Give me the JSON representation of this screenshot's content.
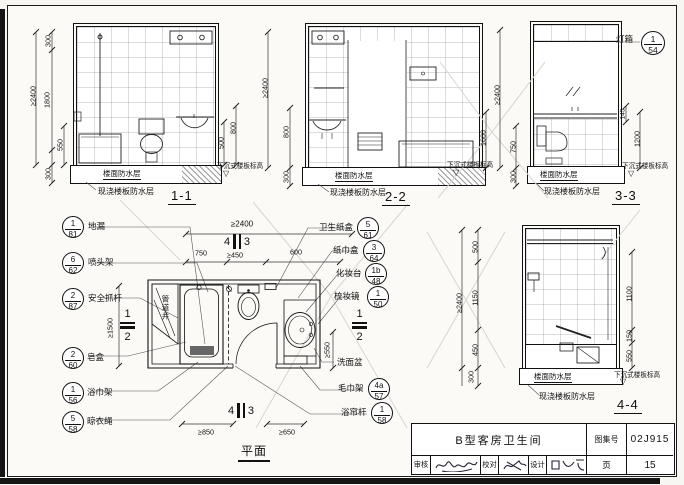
{
  "sheet": {
    "common": {
      "floor_wp": "楼面防水层",
      "slab_wp": "现浇楼板防水层",
      "sunken": "下沉式楼板标高",
      "tri": "▽"
    },
    "elev11": {
      "title": "1-1",
      "total": "≥2400",
      "seg_top": "300",
      "seg_mid": "1800",
      "seg_tub": "550",
      "seg_bot": "300",
      "right_inner": "500",
      "right_outer": "800"
    },
    "elev22": {
      "title": "2-2",
      "total": "≥2400",
      "left_upper": "800",
      "left_lower": "300",
      "right": "1600"
    },
    "elev33": {
      "title": "3-3",
      "total": "≥2400",
      "left_upper": "750",
      "left_lower": "300",
      "right_inner": "145",
      "right_outer": "1200",
      "lightbox_label": "灯箱",
      "lightbox_num": "1",
      "lightbox_den": "54"
    },
    "elev44": {
      "title": "4-4",
      "total": "≥2400",
      "l1": "500",
      "l2": "1150",
      "l3": "450",
      "l4": "300",
      "r1": "1100",
      "r2": "150",
      "r3": "550"
    },
    "plan": {
      "title": "平面",
      "width_total": "≥2400",
      "w1": "750",
      "w2": "≥450",
      "w3": "600",
      "b1": "≥850",
      "b2": "≥650",
      "left_dim": "≥1500",
      "right_dim": "≥550",
      "pipe_shaft": "管道井",
      "basin_label": "洗面盆",
      "sec_top_left": "4",
      "sec_top_right": "3",
      "sec_bot_left": "4",
      "sec_bot_right": "3",
      "sec_side_top": "1",
      "sec_side_bot": "2"
    },
    "callouts_left": [
      {
        "label": "地漏",
        "num": "1",
        "den": "81"
      },
      {
        "label": "喷头架",
        "num": "6",
        "den": "62"
      },
      {
        "label": "安全抓杆",
        "num": "2",
        "den": "87"
      },
      {
        "label": "皂盒",
        "num": "2",
        "den": "60"
      },
      {
        "label": "浴巾架",
        "num": "1",
        "den": "56"
      },
      {
        "label": "晾衣绳",
        "num": "5",
        "den": "58"
      }
    ],
    "callouts_right": [
      {
        "label": "卫生纸盒",
        "num": "5",
        "den": "61"
      },
      {
        "label": "纸巾盒",
        "num": "3",
        "den": "64"
      },
      {
        "label": "化妆台",
        "num": "1b",
        "den": "48"
      },
      {
        "label": "梳妆镜",
        "num": "1",
        "den": "50"
      },
      {
        "label": "毛巾架",
        "num": "4a",
        "den": "57"
      },
      {
        "label": "浴帘杆",
        "num": "1",
        "den": "58"
      }
    ],
    "title_block": {
      "drawing_title": "B型客房卫生间",
      "atlas_label": "图集号",
      "atlas_no": "02J915",
      "page_label": "页",
      "page_no": "15",
      "reviewer_label": "审核",
      "proofread_label": "校对",
      "designer_label": "设计"
    }
  }
}
